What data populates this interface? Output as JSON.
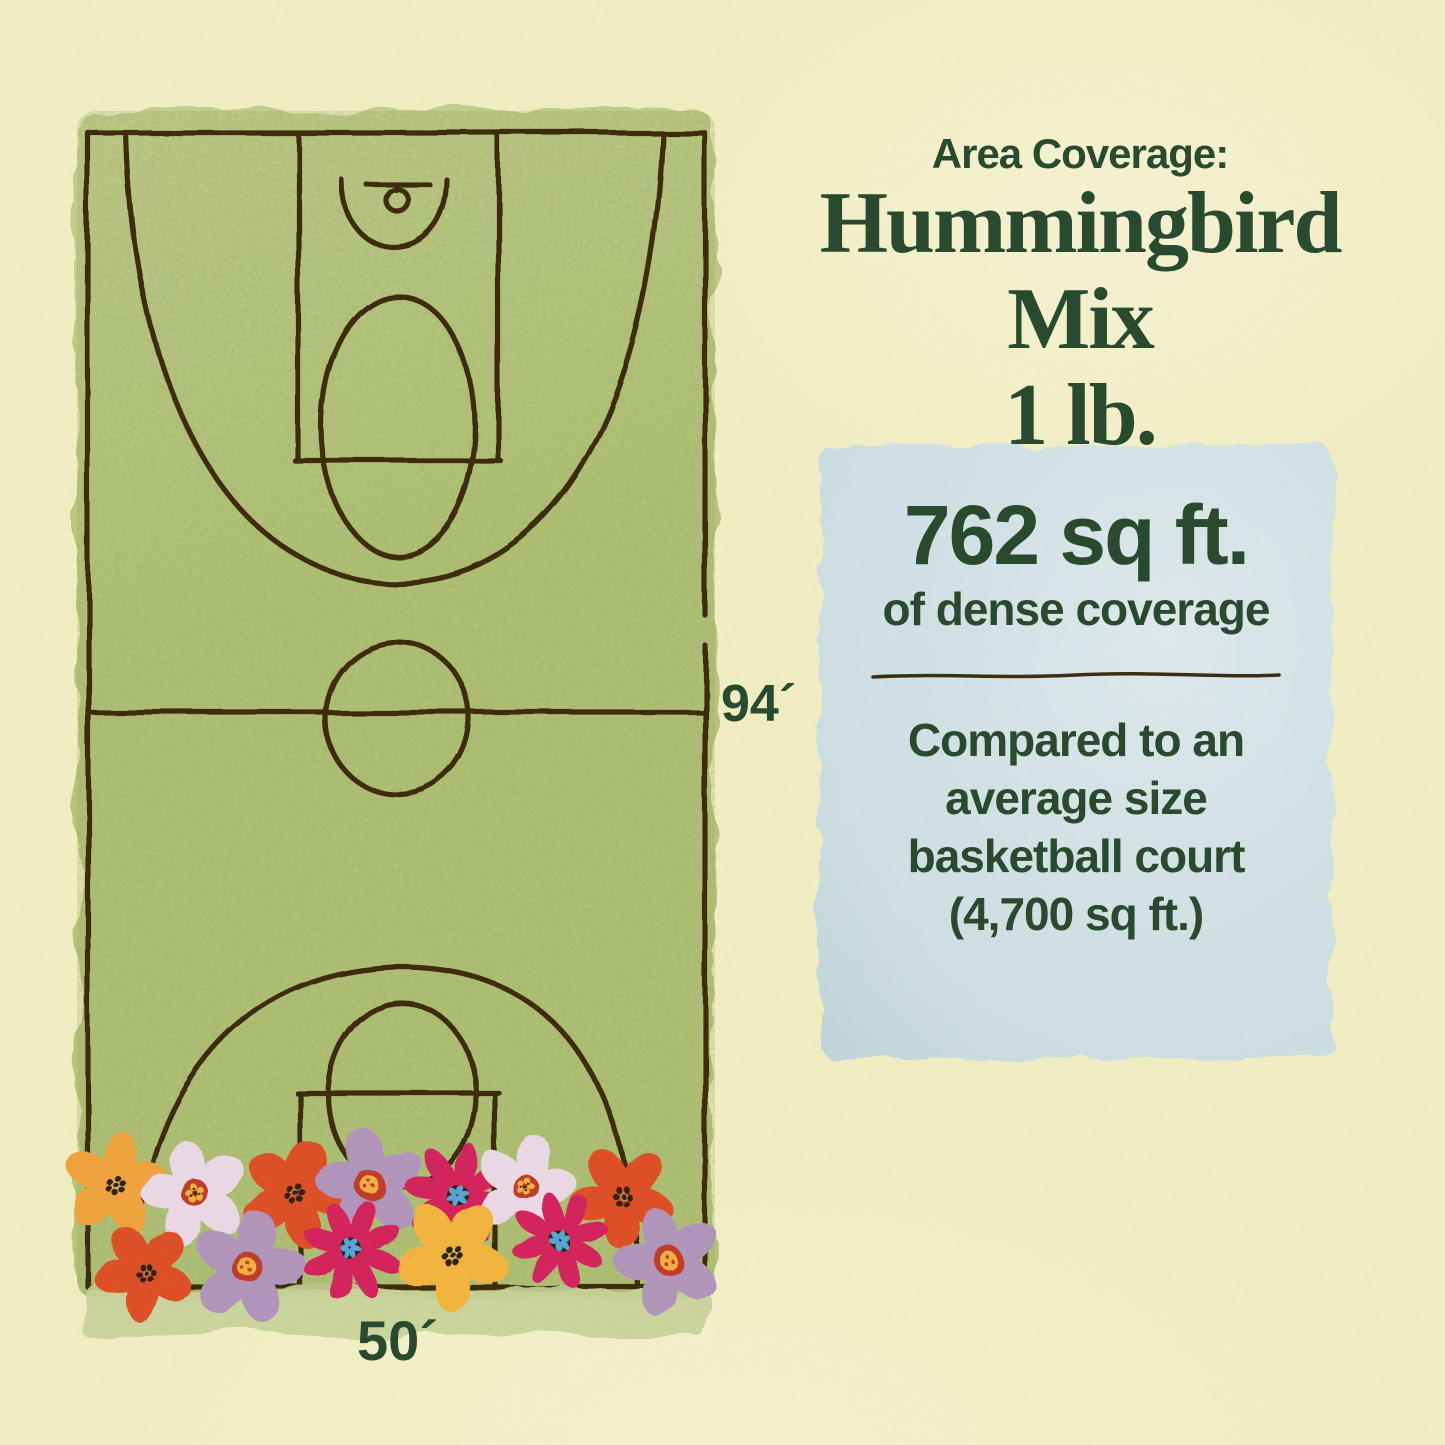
{
  "palette": {
    "background": "#f4f0c5",
    "court_green": "#b6c77c",
    "court_green_light": "#c6d191",
    "line_brown": "#3c2c10",
    "text_green": "#27492f",
    "panel_blue": "#cee0e5",
    "grass_light": "#c8d49a",
    "flower_orange": "#f1a33c",
    "flower_red_orange": "#e04f28",
    "flower_pale_pink": "#ecdbe8",
    "flower_lavender": "#b295bd",
    "flower_magenta": "#d6215f",
    "flower_yellow": "#f4b53e",
    "flower_blue_center": "#54a6d8",
    "center_dark": "#2e2410",
    "center_ring_red": "#c13b2a",
    "center_yellow": "#f3b23f"
  },
  "header": {
    "kicker": "Area Coverage:",
    "title_line1": "Hummingbird Mix",
    "title_line2": "1 lb."
  },
  "coverage_panel": {
    "area_value": "762 sq ft.",
    "area_caption": "of dense coverage",
    "comparison_lines": [
      "Compared to an",
      "average size",
      "basketball court",
      "(4,700 sq ft.)"
    ]
  },
  "court": {
    "length_label": "94´",
    "width_label": "50´"
  }
}
